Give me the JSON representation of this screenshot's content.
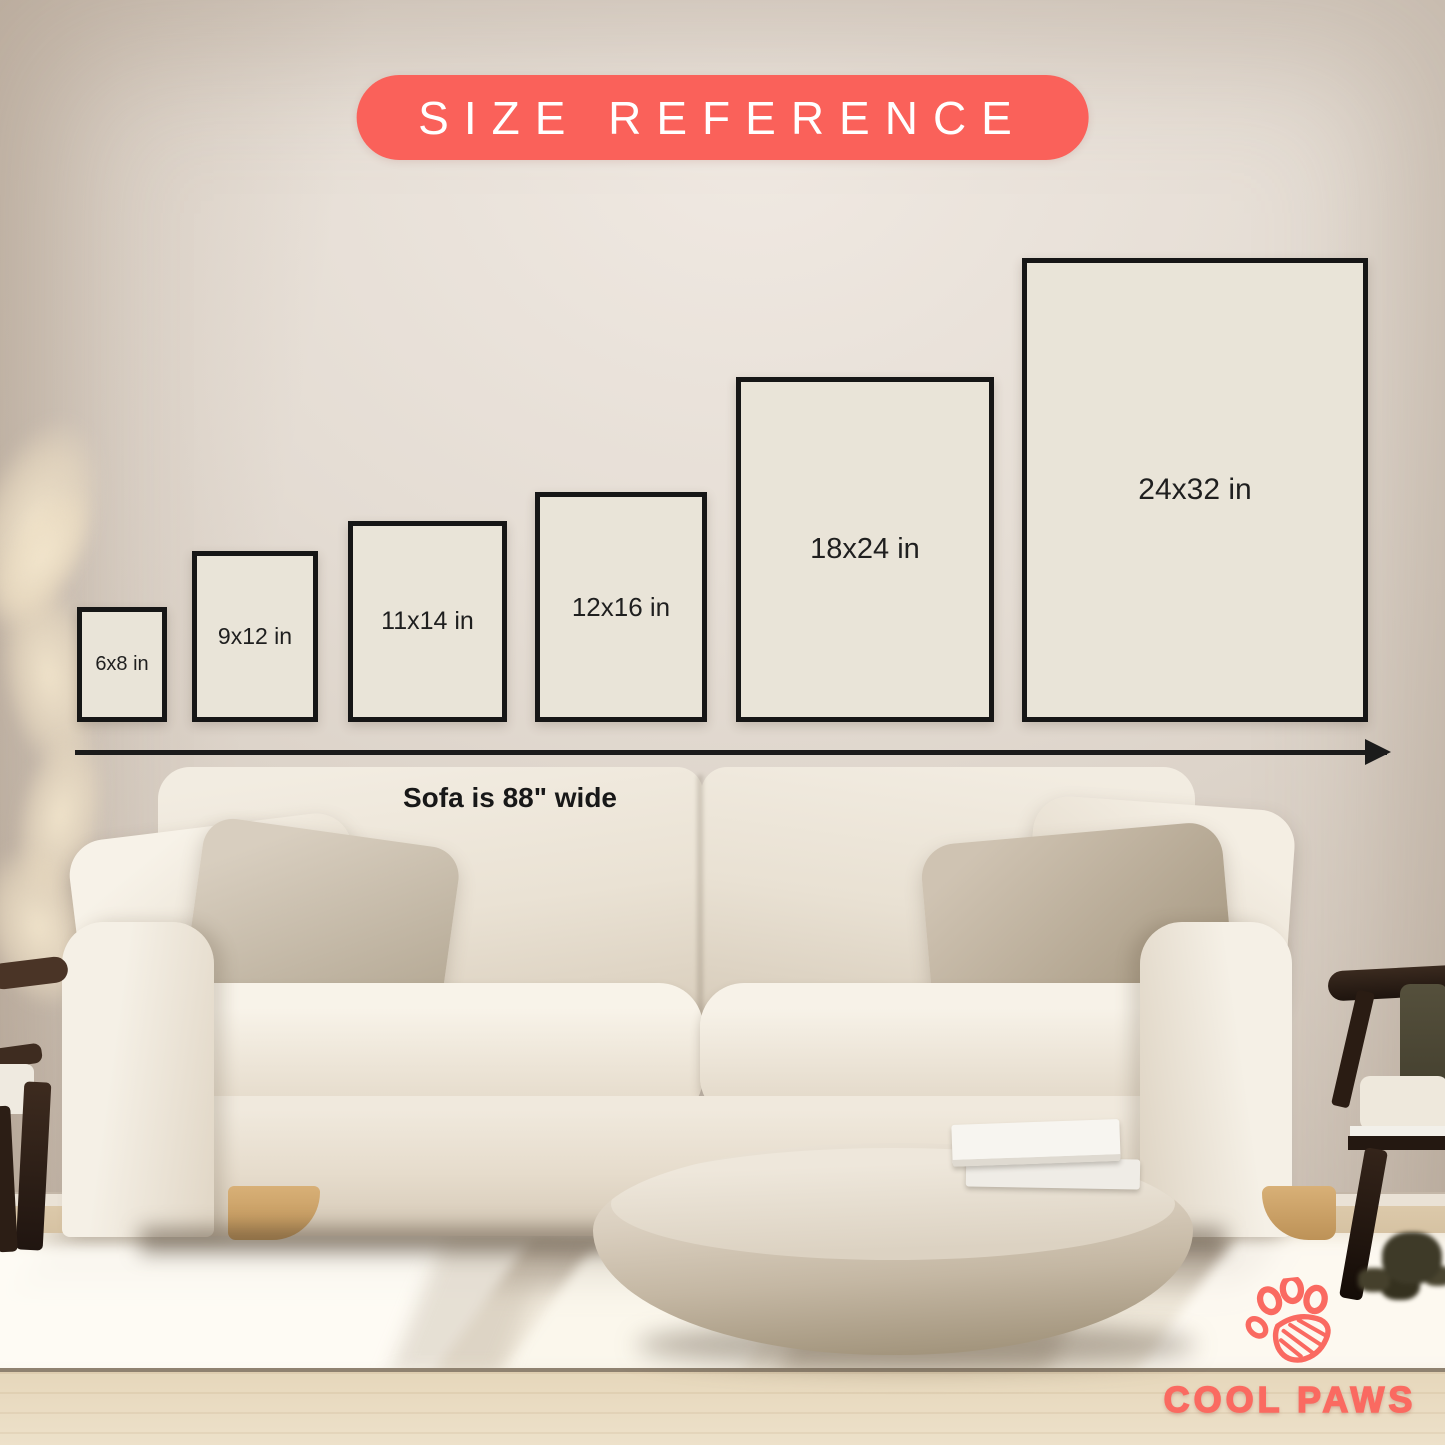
{
  "badge": {
    "label": "SIZE REFERENCE"
  },
  "sizes": [
    {
      "label": "6x8 in",
      "left": 77,
      "width": 90,
      "height": 115,
      "font_px": 20
    },
    {
      "label": "9x12 in",
      "left": 192,
      "width": 126,
      "height": 171,
      "font_px": 23
    },
    {
      "label": "11x14 in",
      "left": 348,
      "width": 159,
      "height": 201,
      "font_px": 25
    },
    {
      "label": "12x16 in",
      "left": 535,
      "width": 172,
      "height": 230,
      "font_px": 26
    },
    {
      "label": "18x24 in",
      "left": 736,
      "width": 258,
      "height": 345,
      "font_px": 29
    },
    {
      "label": "24x32 in",
      "left": 1022,
      "width": 346,
      "height": 464,
      "font_px": 30
    }
  ],
  "sofa": {
    "width_note": "Sofa is 88\" wide"
  },
  "brand": {
    "name": "COOL PAWS",
    "icon": "paw-print-icon"
  },
  "colors": {
    "coral": "#FA615A",
    "box-fill": "#E9E4D8",
    "box-border": "#161616",
    "ink": "#1B1B1B",
    "label": "#1F1F1F",
    "brand": "#FA6A61"
  }
}
